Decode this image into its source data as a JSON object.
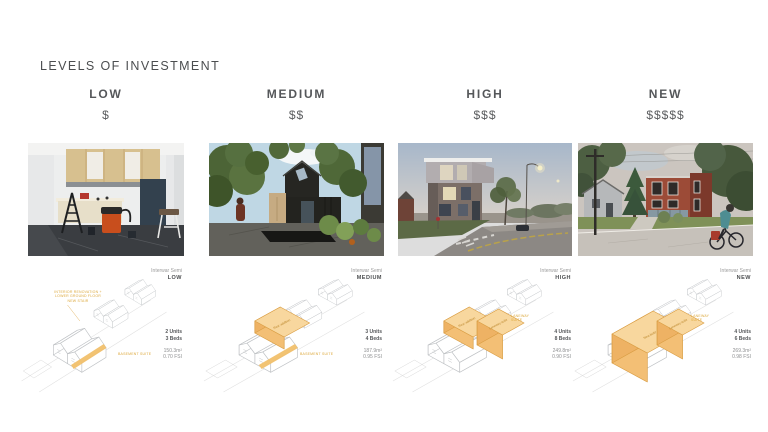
{
  "title": "LEVELS OF INVESTMENT",
  "colors": {
    "accent_yellow": "#f3c27a",
    "axon_line_gray": "#bfc2c5",
    "heading_gray": "#55575a",
    "muted_gray": "#8f9092"
  },
  "columns": [
    {
      "label": "LOW",
      "cost": "$",
      "diagram": {
        "type_label": "Interwar Semi",
        "level_label": "LOW",
        "units": "2 Units",
        "beds": "3 Beds",
        "area": "150.3m²",
        "fsi": "0.70 FSI",
        "annotation_main": "Interior renovation + lower ground floor new stair",
        "annotation_base": "Basement suite"
      }
    },
    {
      "label": "MEDIUM",
      "cost": "$$",
      "diagram": {
        "type_label": "Interwar Semi",
        "level_label": "MEDIUM",
        "units": "3 Units",
        "beds": "4 Beds",
        "area": "187.9m²",
        "fsi": "0.95 FSI",
        "annotation_base": "Basement suite",
        "mass_rear_label": "Rear addition"
      }
    },
    {
      "label": "HIGH",
      "cost": "$$$",
      "diagram": {
        "type_label": "Interwar Semi",
        "level_label": "HIGH",
        "units": "4 Units",
        "beds": "8 Beds",
        "area": "249.8m²",
        "fsi": "0.90 FSI",
        "annotation_side": "Laneway suite",
        "mass_rear_label": "Rear addition",
        "mass_lane_label": "Laneway suite"
      }
    },
    {
      "label": "NEW",
      "cost": "$$$$$",
      "diagram": {
        "type_label": "Interwar Semi",
        "level_label": "NEW",
        "units": "4 Units",
        "beds": "6 Beds",
        "area": "269.3m²",
        "fsi": "0.98 FSI",
        "annotation_side": "Laneway suite",
        "mass_main_label": "New build",
        "mass_lane_label": "Laneway suite"
      }
    }
  ]
}
